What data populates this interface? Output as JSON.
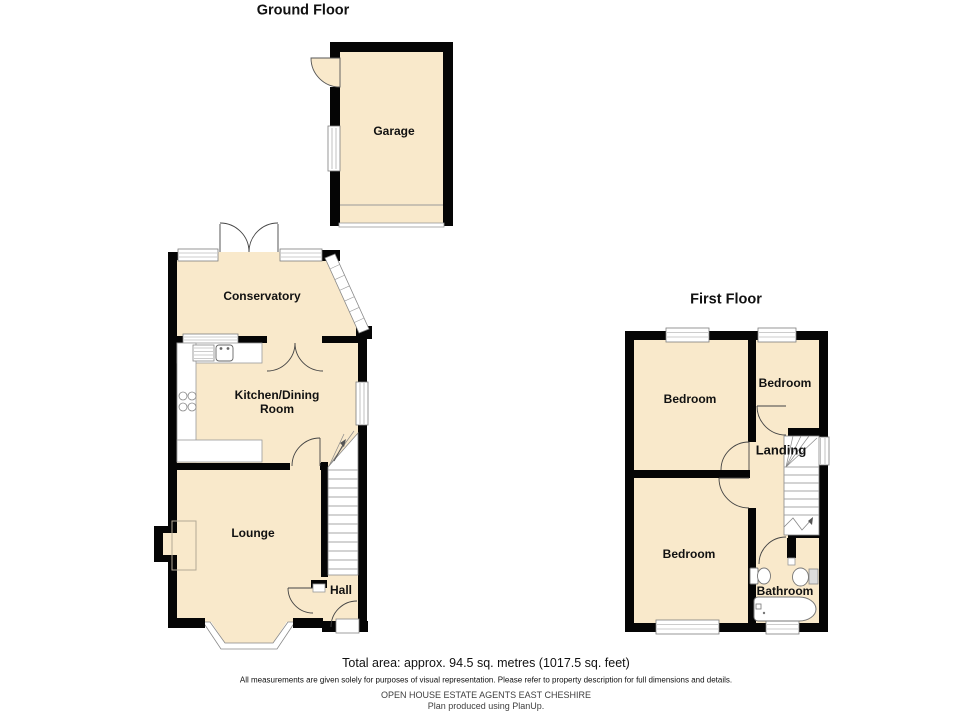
{
  "ground_floor": {
    "title": "Ground Floor",
    "rooms": {
      "garage": "Garage",
      "conservatory": "Conservatory",
      "kitchen": "Kitchen/Dining Room",
      "lounge": "Lounge",
      "hall": "Hall"
    }
  },
  "first_floor": {
    "title": "First Floor",
    "rooms": {
      "bedroom_left": "Bedroom",
      "bedroom_right": "Bedroom",
      "bedroom_bottom": "Bedroom",
      "landing": "Landing",
      "bathroom": "Bathroom"
    }
  },
  "footer": {
    "total_area": "Total area: approx. 94.5 sq. metres (1017.5 sq. feet)",
    "disclaimer": "All measurements are given solely for purposes of visual representation. Please refer to property description for full dimensions and details.",
    "agent": "OPEN HOUSE ESTATE AGENTS EAST CHESHIRE",
    "produced": "Plan produced using PlanUp."
  },
  "colors": {
    "floor": "#F9E9CB",
    "wall": "#050505",
    "window_fill": "#FFFFFF",
    "window_border": "#7d7d7d",
    "door_arc": "#444444",
    "stair_line": "#8a8a8a"
  }
}
